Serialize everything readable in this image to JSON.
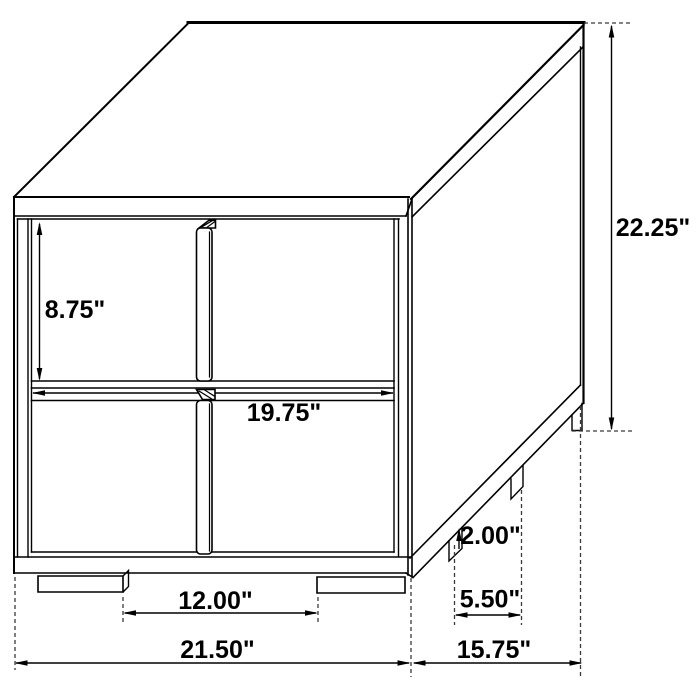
{
  "canvas": {
    "width": 700,
    "height": 700,
    "background": "#ffffff"
  },
  "diagram": {
    "kind": "product-dimension-line-drawing",
    "subject": "two-drawer nightstand, three-quarter line view with dimension arrows",
    "stroke_color": "#000000",
    "label_color": "#000000",
    "units": "inches",
    "dimensions": {
      "drawer_front_height": {
        "value": 8.75,
        "display": "8.75\"",
        "measures": "upper drawer front height"
      },
      "overall_height": {
        "value": 22.25,
        "display": "22.25\"",
        "measures": "overall height including feet"
      },
      "drawer_width": {
        "value": 19.75,
        "display": "19.75\"",
        "measures": "drawer front width"
      },
      "foot_height": {
        "value": 2.0,
        "display": "2.00\"",
        "measures": "base / foot height"
      },
      "front_feet_gap": {
        "value": 12.0,
        "display": "12.00\"",
        "measures": "spacing between front feet"
      },
      "side_feet_gap": {
        "value": 5.5,
        "display": "5.50\"",
        "measures": "spacing between side feet"
      },
      "overall_width": {
        "value": 21.5,
        "display": "21.50\"",
        "measures": "overall width"
      },
      "overall_depth": {
        "value": 15.75,
        "display": "15.75\"",
        "measures": "overall depth"
      }
    }
  }
}
